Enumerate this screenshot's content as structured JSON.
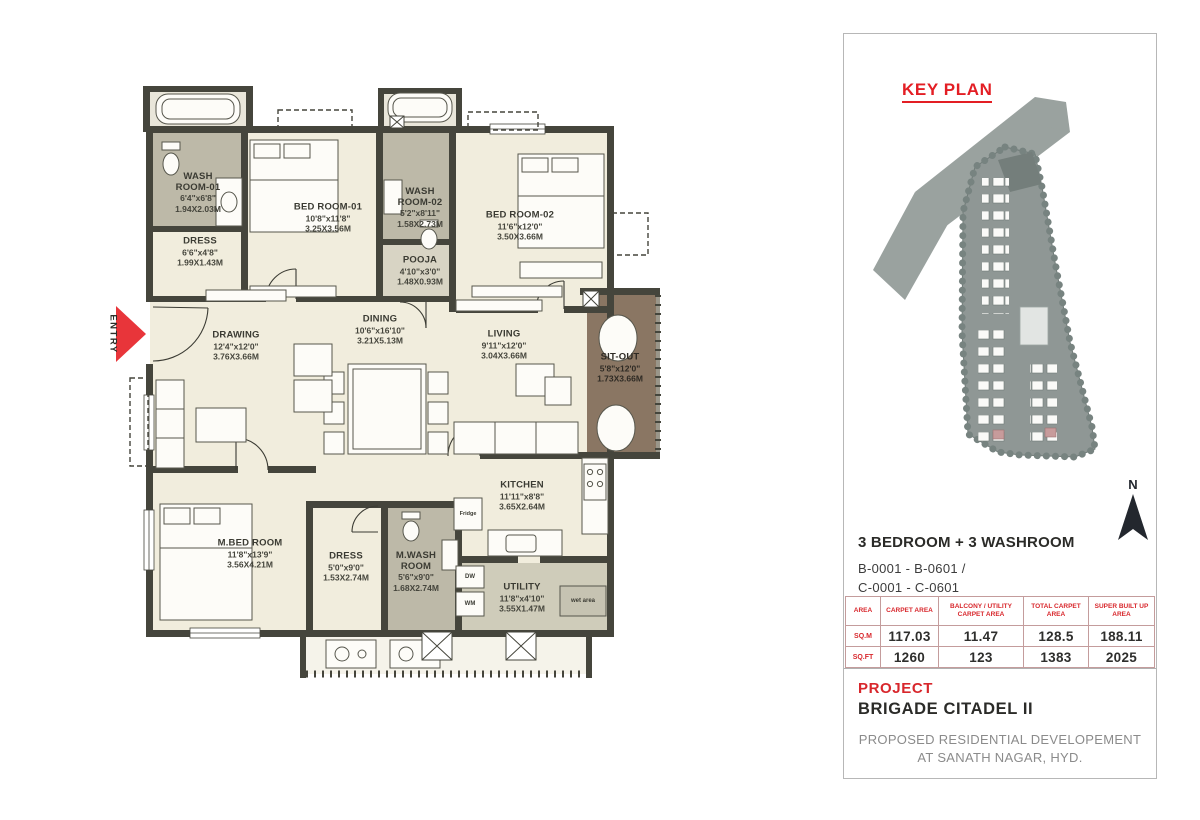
{
  "colors": {
    "accent_red": "#e31e24",
    "wall": "#45453c",
    "floor": "#f1eddd",
    "washroom_floor": "#bdb9a8",
    "utility_floor": "#cfccba",
    "sitout_floor": "#8a7663",
    "site_grey": "#8f9795",
    "highlight_block_pink": "#c79b9b"
  },
  "floorplan": {
    "entry_label": "ENTRY",
    "rooms": [
      {
        "name": "WASH ROOM-01",
        "ft": "6'4\"x6'8\"",
        "m": "1.94X2.03M"
      },
      {
        "name": "DRESS",
        "ft": "6'6\"x4'8\"",
        "m": "1.99X1.43M"
      },
      {
        "name": "BED ROOM-01",
        "ft": "10'8\"x11'8\"",
        "m": "3.25X3.56M"
      },
      {
        "name": "WASH ROOM-02",
        "ft": "5'2\"x8'11\"",
        "m": "1.58X2.73M"
      },
      {
        "name": "POOJA",
        "ft": "4'10\"x3'0\"",
        "m": "1.48X0.93M"
      },
      {
        "name": "BED ROOM-02",
        "ft": "11'6\"x12'0\"",
        "m": "3.50X3.66M"
      },
      {
        "name": "DRAWING",
        "ft": "12'4\"x12'0\"",
        "m": "3.76X3.66M"
      },
      {
        "name": "DINING",
        "ft": "10'6\"x16'10\"",
        "m": "3.21X5.13M"
      },
      {
        "name": "LIVING",
        "ft": "9'11\"x12'0\"",
        "m": "3.04X3.66M"
      },
      {
        "name": "SIT-OUT",
        "ft": "5'8\"x12'0\"",
        "m": "1.73X3.66M"
      },
      {
        "name": "M.BED ROOM",
        "ft": "11'8\"x13'9\"",
        "m": "3.56X4.21M"
      },
      {
        "name": "DRESS",
        "ft": "5'0\"x9'0\"",
        "m": "1.53X2.74M"
      },
      {
        "name": "M.WASH ROOM",
        "ft": "5'6\"x9'0\"",
        "m": "1.68X2.74M"
      },
      {
        "name": "KITCHEN",
        "ft": "11'11\"x8'8\"",
        "m": "3.65X2.64M"
      },
      {
        "name": "UTILITY",
        "ft": "11'8\"x4'10\"",
        "m": "3.55X1.47M"
      }
    ],
    "labels": {
      "fridge": "Fridge",
      "dishwasher": "DW",
      "washing_machine": "WM",
      "wet_area": "wet area"
    }
  },
  "sidebar": {
    "key_plan_title": "KEY PLAN",
    "north_label": "N",
    "unit_type": "3 BEDROOM + 3 WASHROOM",
    "unit_range_line1": "B-0001 - B-0601 /",
    "unit_range_line2": "C-0001 - C-0601",
    "area_table": {
      "col_headers": [
        "AREA",
        "CARPET AREA",
        "BALCONY / UTILITY CARPET AREA",
        "TOTAL CARPET AREA",
        "SUPER BUILT UP AREA"
      ],
      "rows": [
        {
          "label": "SQ.M",
          "values": [
            "117.03",
            "11.47",
            "128.5",
            "188.11"
          ]
        },
        {
          "label": "SQ.FT",
          "values": [
            "1260",
            "123",
            "1383",
            "2025"
          ]
        }
      ]
    },
    "project_label": "PROJECT",
    "project_name": "BRIGADE CITADEL II",
    "project_description_line1": "PROPOSED RESIDENTIAL DEVELOPEMENT",
    "project_description_line2": "AT SANATH NAGAR, HYD."
  }
}
